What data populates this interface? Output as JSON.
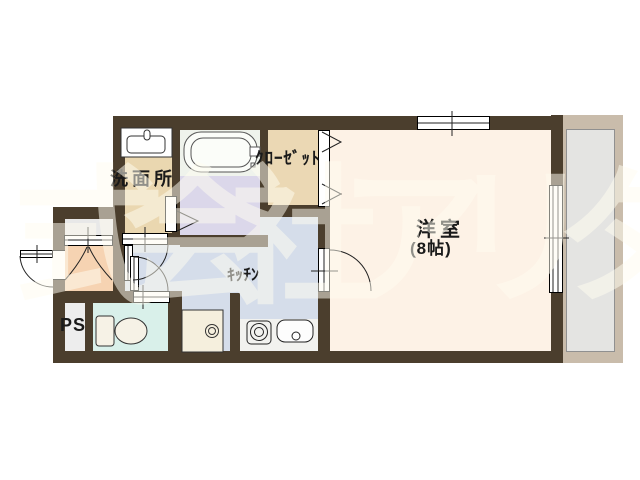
{
  "floorplan": {
    "watermark_text": "式会社アリタヤ",
    "labels": {
      "living_room": "洋室",
      "living_size": "(8帖)",
      "kitchen": "ｷｯﾁﾝ",
      "washroom": "洗面所",
      "closet": "ｸﾛｰｾﾞｯﾄ",
      "pipe_space": "PS"
    },
    "colors": {
      "wall": "#4b3e2d",
      "living_floor": "#fdf2e6",
      "kitchen_floor": "#d5ddea",
      "washroom_floor": "#ead7b0",
      "closet_floor": "#ebd8b4",
      "bathroom_floor": "#dbd7ea",
      "bathtub_zone": "#eff3ec",
      "entrance_floor": "#f6d3b2",
      "toilet_floor": "#d9f0ea",
      "pipe_space_floor": "#ededed",
      "alcove_floor": "#e8e8e8",
      "counter": "#f2f2ef",
      "balcony_frame": "#c9bcab",
      "balcony_floor": "#e4e4e2",
      "label_text": "#1a1a1a",
      "watermark": "#fffdf0"
    }
  }
}
